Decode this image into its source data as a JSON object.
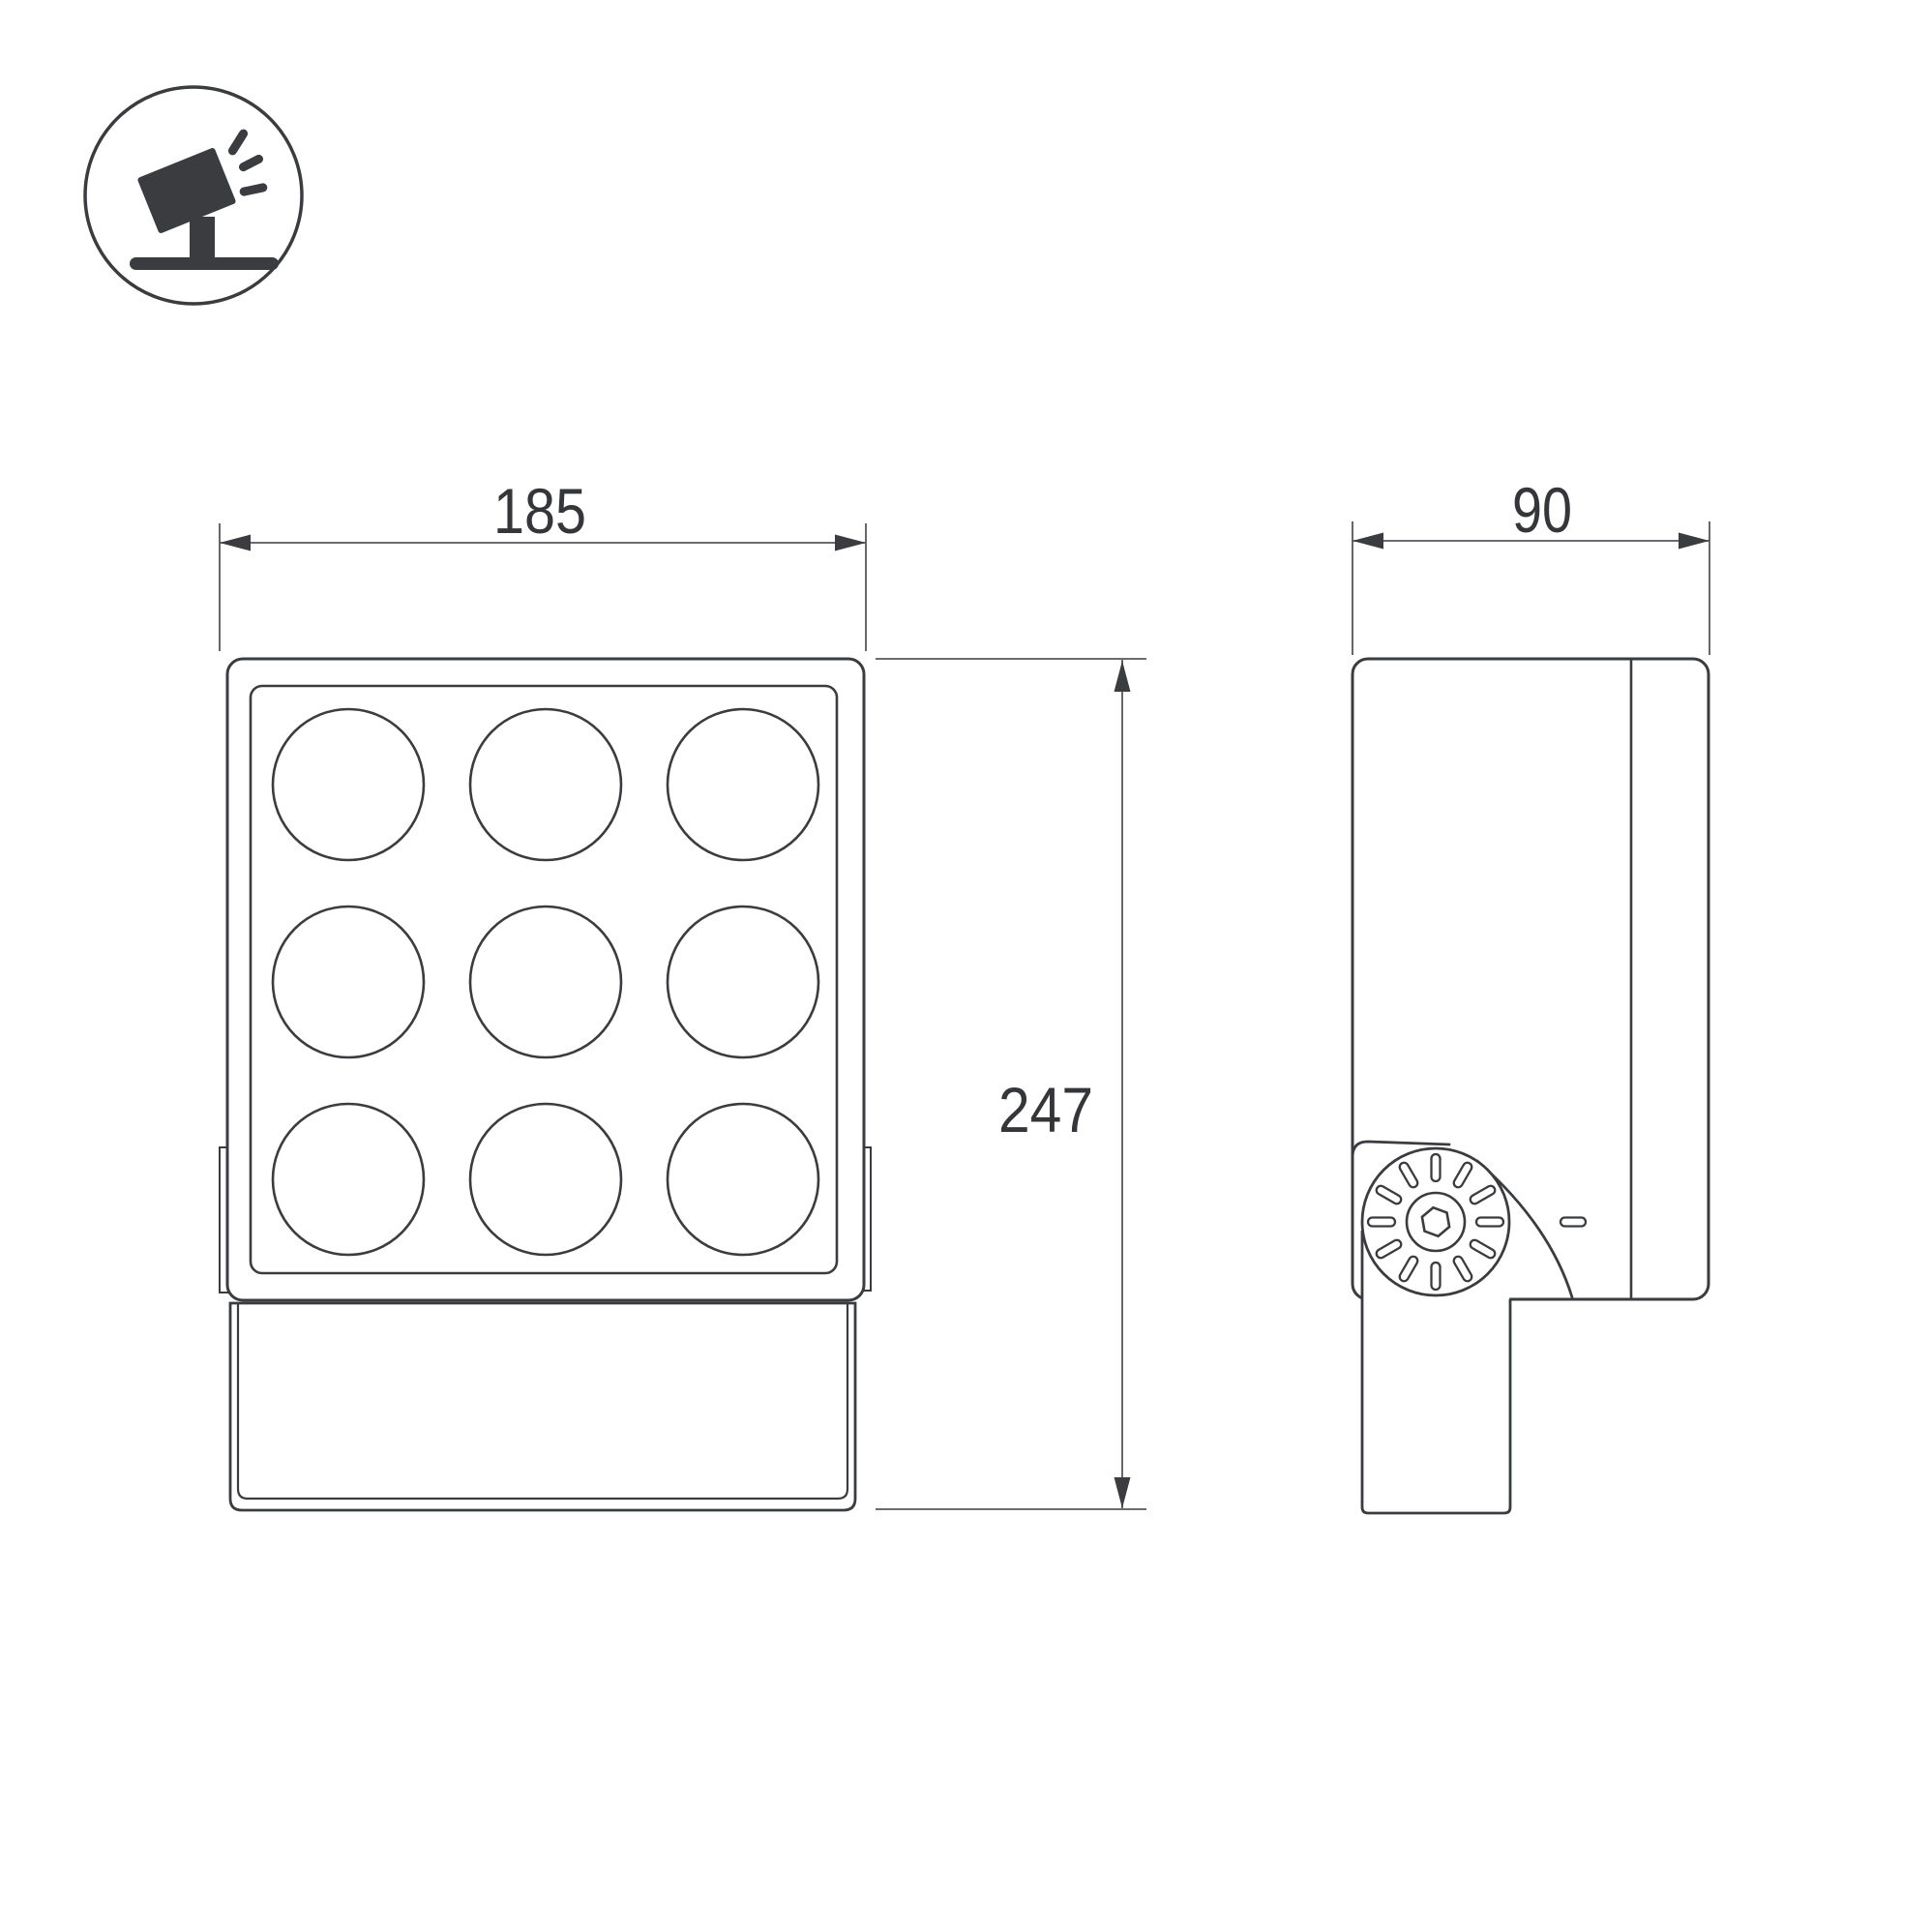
{
  "page": {
    "background": "#ffffff",
    "line_color": "#3b3c3f",
    "dim_line_color": "#56575b",
    "text_color": "#353639"
  },
  "icon": {
    "name": "tilted-spotlight-on-stand"
  },
  "dimensions": {
    "front_width": {
      "value": "185"
    },
    "side_width": {
      "value": "90"
    },
    "front_height": {
      "value": "247"
    }
  },
  "diagram": {
    "type": "technical-dimension-drawing",
    "subject": "LED floodlight, front view and side view",
    "front_view": {
      "lens_rows": 3,
      "lens_cols": 3
    },
    "side_view": {
      "knob_tick_count": 12
    }
  }
}
